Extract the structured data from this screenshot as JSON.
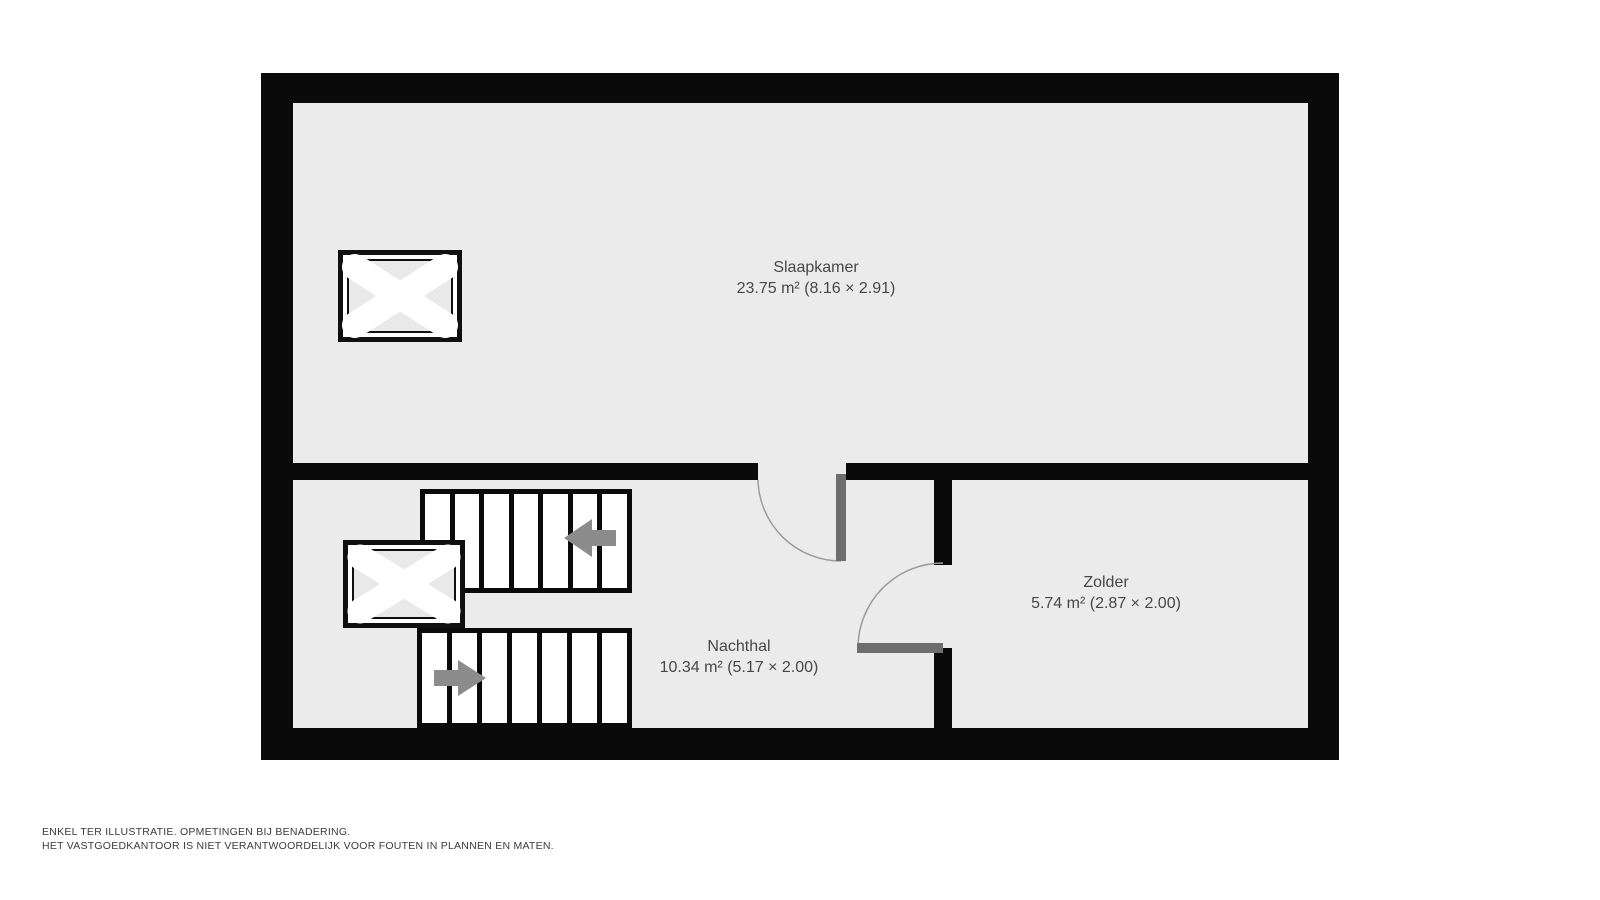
{
  "floorplan": {
    "rooms": [
      {
        "name": "Slaapkamer",
        "dimensions": "23.75 m² (8.16 × 2.91)"
      },
      {
        "name": "Zolder",
        "dimensions": "5.74 m² (2.87 × 2.00)"
      },
      {
        "name": "Nachthal",
        "dimensions": "10.34 m² (5.17 × 2.00)"
      }
    ],
    "icons": {
      "skylight": "roof-window-x-icon",
      "stairs_up": "arrow-left-icon",
      "stairs_down": "arrow-right-icon",
      "door_swing": "quarter-arc-door-icon"
    },
    "colors": {
      "wall": "#0a0a0a",
      "floor": "#ebebeb",
      "tread": "#ffffff",
      "door_leaf": "#6e6e6e",
      "swing_arc": "#9b9b9b",
      "arrow": "#8c8c8c",
      "label_text": "#474747"
    }
  },
  "footer": {
    "line1": "ENKEL TER ILLUSTRATIE. OPMETINGEN BIJ BENADERING.",
    "line2": "HET VASTGOEDKANTOOR IS NIET VERANTWOORDELIJK VOOR FOUTEN IN PLANNEN EN MATEN."
  }
}
